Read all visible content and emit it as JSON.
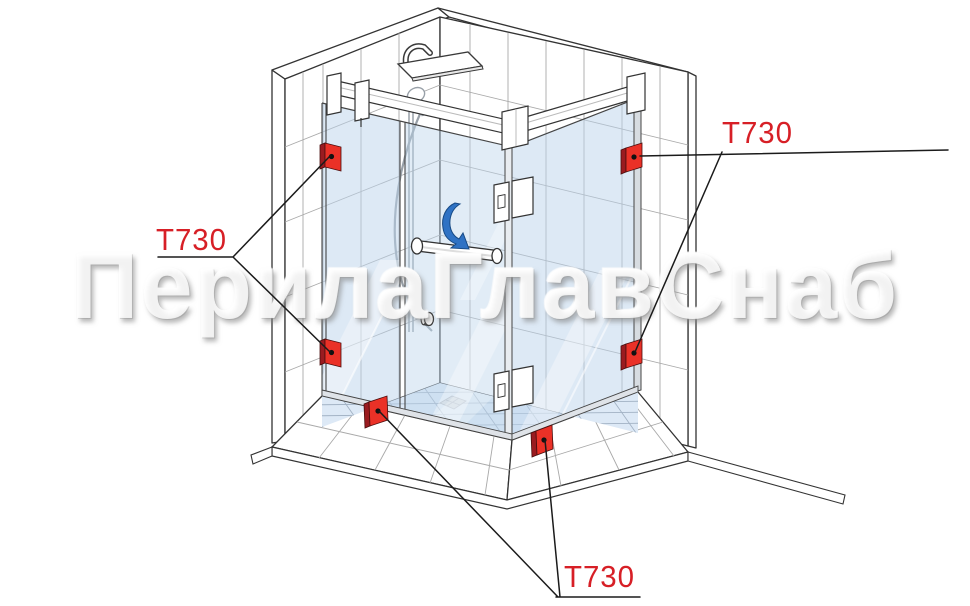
{
  "page": {
    "width": 970,
    "height": 606,
    "background": "#ffffff"
  },
  "watermark": {
    "text": "ПерилаГлавСнаб"
  },
  "diagram": {
    "subject": "Corner shower enclosure with hinged glass door; T730 glass clamps highlighted at wall and floor mounting points",
    "callouts": [
      {
        "id": "callout-left",
        "text": "Т730",
        "points_to": [
          "left-wall-top-clamp",
          "left-wall-bottom-clamp"
        ]
      },
      {
        "id": "callout-top-right",
        "text": "Т730",
        "points_to": [
          "right-wall-top-clamp",
          "right-wall-bottom-clamp"
        ]
      },
      {
        "id": "callout-bottom",
        "text": "Т730",
        "points_to": [
          "floor-clamp-door-side",
          "floor-clamp-return-side"
        ]
      }
    ],
    "clamps": [
      {
        "id": "left-wall-top-clamp",
        "part": "Т730"
      },
      {
        "id": "left-wall-bottom-clamp",
        "part": "Т730"
      },
      {
        "id": "right-wall-top-clamp",
        "part": "Т730"
      },
      {
        "id": "right-wall-bottom-clamp",
        "part": "Т730"
      },
      {
        "id": "floor-clamp-door-side",
        "part": "Т730"
      },
      {
        "id": "floor-clamp-return-side",
        "part": "Т730"
      }
    ],
    "colors": {
      "callout_red": "#d71f26",
      "clamp_red": "#ea3127",
      "clamp_red_shadow": "#9a1b20",
      "glass_blue": "#bcd4ec",
      "floor_blue": "#dde9f6",
      "arrow_blue": "#2f72c4",
      "line_dark": "#333333",
      "tile_grout": "#a9a9a9"
    }
  }
}
